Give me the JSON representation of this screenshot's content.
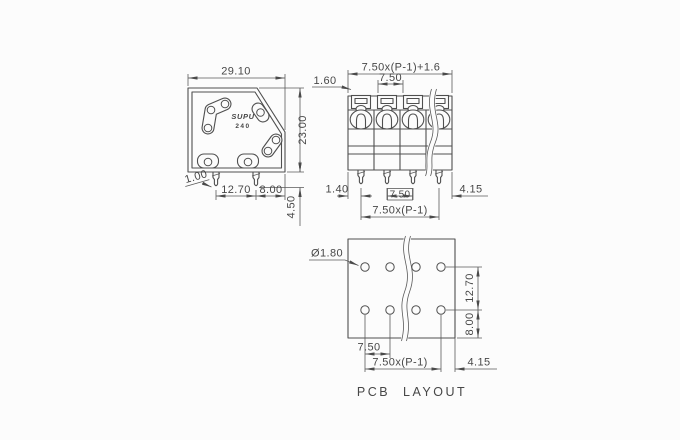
{
  "colors": {
    "background": "#fcfcfc",
    "line": "#4f4f4f",
    "text": "#474747"
  },
  "side_view": {
    "logo_line1": "SUPU",
    "logo_line2": "240",
    "dim_width": "29.10",
    "dim_height": "23.00",
    "dim_pin_thickness": "1.00",
    "dim_pin_spacing": "12.70",
    "dim_pin_to_edge": "8.00",
    "dim_pin_length": "4.50"
  },
  "front_view": {
    "dim_total_width": "7.50x(P-1)+1.6",
    "dim_wall": "1.60",
    "dim_pitch_top": "7.50",
    "dim_left_offset": "1.40",
    "dim_pitch_bottom": "7.50",
    "dim_right_offset": "4.15",
    "dim_pin_span": "7.50x(P-1)"
  },
  "pcb_layout": {
    "dim_hole_diameter": "Ø1.80",
    "dim_row_spacing": "12.70",
    "dim_row_to_edge": "8.00",
    "dim_hole_pitch": "7.50",
    "dim_hole_span": "7.50x(P-1)",
    "dim_right_offset": "4.15",
    "caption": "PCB LAYOUT"
  }
}
